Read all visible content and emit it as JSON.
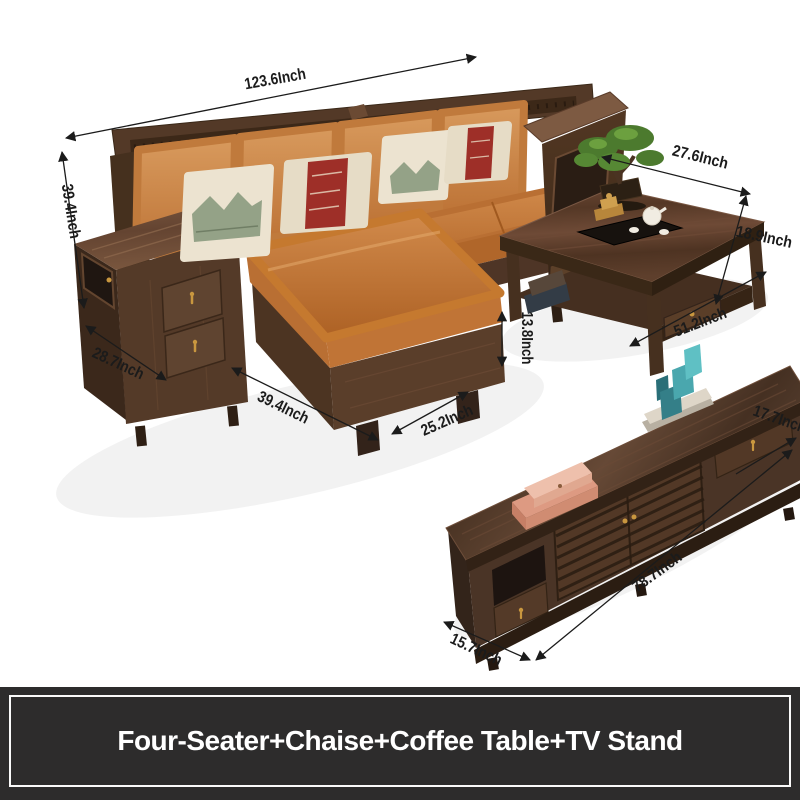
{
  "caption": {
    "text": "Four-Seater+Chaise+Coffee Table+TV Stand"
  },
  "dimensions": {
    "sofa_total_width": "123.6Inch",
    "sofa_back_height": "39.4Inch",
    "left_armrest_depth": "28.7Inch",
    "chaise_length": "39.4Inch",
    "chaise_width": "25.2Inch",
    "table_shelf_clearance": "13.8Inch",
    "coffee_table_depth": "27.6Inch",
    "coffee_table_height": "18.9Inch",
    "coffee_table_length": "51.2Inch",
    "tv_stand_height": "17.7Inch",
    "tv_stand_length": "78.7Inch",
    "tv_stand_depth": "15.7Inch"
  },
  "colors": {
    "leather_orange": "#c97c3e",
    "wood_dark": "#4a3326",
    "wood_mid": "#6b4a33",
    "pillow_cream": "#ece3d0",
    "pillow_red": "#9e2f28",
    "decor_teal": "#4aa7ae",
    "decor_salmon": "#e09a82",
    "brass": "#c9973f",
    "dimension_line": "#1b1b1b",
    "caption_background": "#2d2c2c",
    "caption_text": "#ffffff"
  }
}
